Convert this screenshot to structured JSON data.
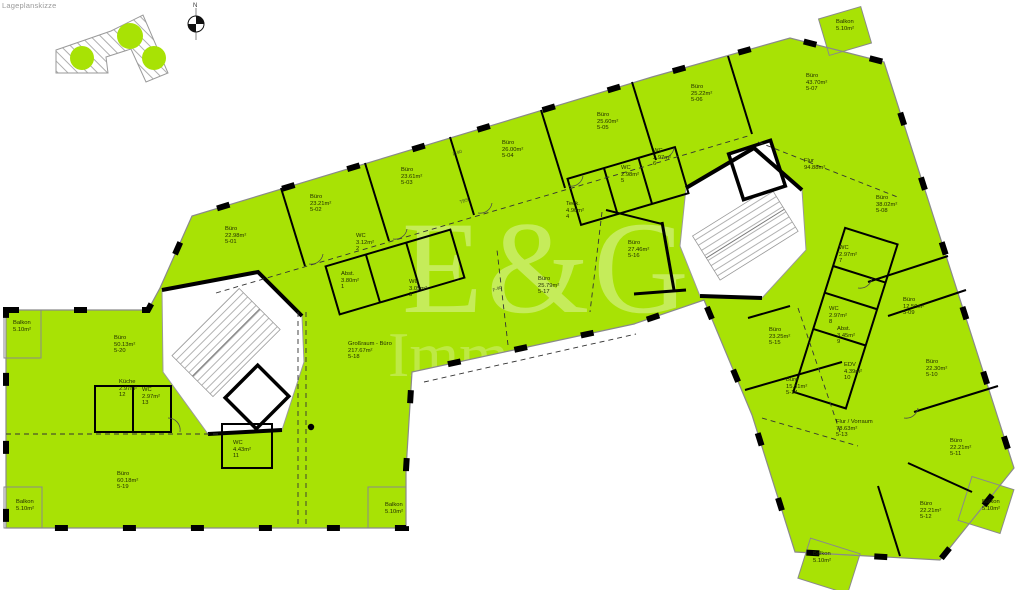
{
  "title": "Lageplanskizze",
  "compass_label": "N",
  "watermark": {
    "line1": "E&G",
    "line2": "Immo"
  },
  "colors": {
    "room_green": "#a8e205",
    "wall_black": "#111111",
    "outline_gray": "#999999",
    "label_color": "#1f2a02",
    "watermark_white": "rgba(255,255,255,0.33)"
  },
  "rooms": [
    {
      "name": "Büro",
      "area": "22.98m²",
      "num": "5-01",
      "x": 225,
      "y": 226
    },
    {
      "name": "Büro",
      "area": "23.21m²",
      "num": "5-02",
      "x": 310,
      "y": 194
    },
    {
      "name": "Büro",
      "area": "23.61m²",
      "num": "5-03",
      "x": 401,
      "y": 167
    },
    {
      "name": "Büro",
      "area": "26.00m²",
      "num": "5-04",
      "x": 502,
      "y": 140
    },
    {
      "name": "Büro",
      "area": "25.60m²",
      "num": "5-05",
      "x": 597,
      "y": 112
    },
    {
      "name": "Büro",
      "area": "25.22m²",
      "num": "5-06",
      "x": 691,
      "y": 84
    },
    {
      "name": "Büro",
      "area": "43.70m²",
      "num": "5-07",
      "x": 806,
      "y": 73
    },
    {
      "name": "Balkon",
      "area": "5.10m²",
      "num": "",
      "x": 836,
      "y": 19
    },
    {
      "name": "Flur",
      "area": "94.88m²",
      "num": "",
      "x": 804,
      "y": 158
    },
    {
      "name": "Büro",
      "area": "38.02m²",
      "num": "5-08",
      "x": 876,
      "y": 195
    },
    {
      "name": "WC",
      "area": "2.97m²",
      "num": "7",
      "x": 839,
      "y": 245
    },
    {
      "name": "Büro",
      "area": "12.50m²",
      "num": "5-09",
      "x": 903,
      "y": 297
    },
    {
      "name": "WC",
      "area": "2.97m²",
      "num": "8",
      "x": 829,
      "y": 306
    },
    {
      "name": "Abst.",
      "area": "3.45m²",
      "num": "9",
      "x": 837,
      "y": 326
    },
    {
      "name": "EDV",
      "area": "4.39m²",
      "num": "10",
      "x": 844,
      "y": 362
    },
    {
      "name": "Büro",
      "area": "23.25m²",
      "num": "5-15",
      "x": 769,
      "y": 327
    },
    {
      "name": "Büro",
      "area": "15.81m²",
      "num": "5-14",
      "x": 786,
      "y": 377
    },
    {
      "name": "Büro",
      "area": "22.30m²",
      "num": "5-10",
      "x": 926,
      "y": 359
    },
    {
      "name": "Flur / Vorraum",
      "area": "78.63m²",
      "num": "5-13",
      "x": 836,
      "y": 419
    },
    {
      "name": "Büro",
      "area": "22.21m²",
      "num": "5-11",
      "x": 950,
      "y": 438
    },
    {
      "name": "Büro",
      "area": "22.21m²",
      "num": "5-12",
      "x": 920,
      "y": 501
    },
    {
      "name": "Balkon",
      "area": "5.10m²",
      "num": "",
      "x": 982,
      "y": 499
    },
    {
      "name": "Balkon",
      "area": "5.10m²",
      "num": "",
      "x": 813,
      "y": 551
    },
    {
      "name": "Großraum - Büro",
      "area": "217.67m²",
      "num": "5-18",
      "x": 348,
      "y": 341
    },
    {
      "name": "Büro",
      "area": "27.46m²",
      "num": "5-16",
      "x": 628,
      "y": 240
    },
    {
      "name": "Büro",
      "area": "25.79m²",
      "num": "5-17",
      "x": 538,
      "y": 276
    },
    {
      "name": "WC",
      "area": "3.12m²",
      "num": "2",
      "x": 356,
      "y": 233
    },
    {
      "name": "Abst.",
      "area": "3.80m²",
      "num": "1",
      "x": 341,
      "y": 271
    },
    {
      "name": "WC",
      "area": "3.05m²",
      "num": "3",
      "x": 409,
      "y": 279
    },
    {
      "name": "Teek.",
      "area": "4.90m²",
      "num": "4",
      "x": 566,
      "y": 201
    },
    {
      "name": "WC",
      "area": "2.98m²",
      "num": "5",
      "x": 621,
      "y": 165
    },
    {
      "name": "WC",
      "area": "2.97m²",
      "num": "6",
      "x": 653,
      "y": 148
    },
    {
      "name": "Balkon",
      "area": "5.10m²",
      "num": "",
      "x": 13,
      "y": 320
    },
    {
      "name": "Büro",
      "area": "50.13m²",
      "num": "5-20",
      "x": 114,
      "y": 335
    },
    {
      "name": "Küche",
      "area": "2.97m²",
      "num": "12",
      "x": 119,
      "y": 379
    },
    {
      "name": "WC",
      "area": "2.97m²",
      "num": "13",
      "x": 142,
      "y": 387
    },
    {
      "name": "Büro",
      "area": "60.18m²",
      "num": "5-19",
      "x": 117,
      "y": 471
    },
    {
      "name": "Balkon",
      "area": "5.10m²",
      "num": "",
      "x": 16,
      "y": 499
    },
    {
      "name": "WC",
      "area": "4.43m²",
      "num": "11",
      "x": 233,
      "y": 440
    },
    {
      "name": "Balkon",
      "area": "5.10m²",
      "num": "",
      "x": 385,
      "y": 502
    }
  ],
  "annotations": [
    {
      "text": "F-90",
      "x": 452,
      "y": 152,
      "rot": -20
    },
    {
      "text": "F-90",
      "x": 492,
      "y": 288,
      "rot": -20
    },
    {
      "text": "TBS",
      "x": 459,
      "y": 200,
      "rot": -20
    }
  ]
}
